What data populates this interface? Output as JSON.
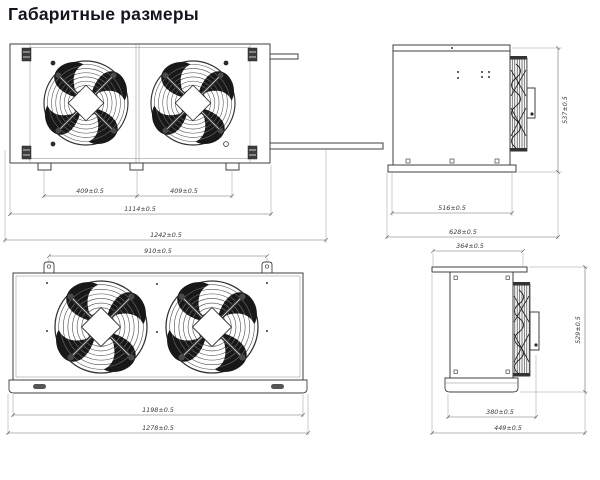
{
  "title": "Габаритные размеры",
  "drawings": {
    "unit1_front": {
      "dims": {
        "fan_pitch_left": "409±0.5",
        "fan_pitch_right": "409±0.5",
        "mounting_width": "1114±0.5",
        "overall_width": "1242±0.5"
      }
    },
    "unit1_side": {
      "dims": {
        "height": "537±0.5",
        "base_depth": "516±0.5",
        "overall_depth": "628±0.5"
      }
    },
    "unit2_front": {
      "dims": {
        "bracket_pitch": "910±0.5",
        "body_width": "1198±0.5",
        "overall_width": "1278±0.5"
      }
    },
    "unit2_side": {
      "dims": {
        "flange_depth": "364±0.5",
        "height": "529±0.5",
        "body_depth": "380±0.5",
        "overall_depth": "449±0.5"
      }
    }
  }
}
